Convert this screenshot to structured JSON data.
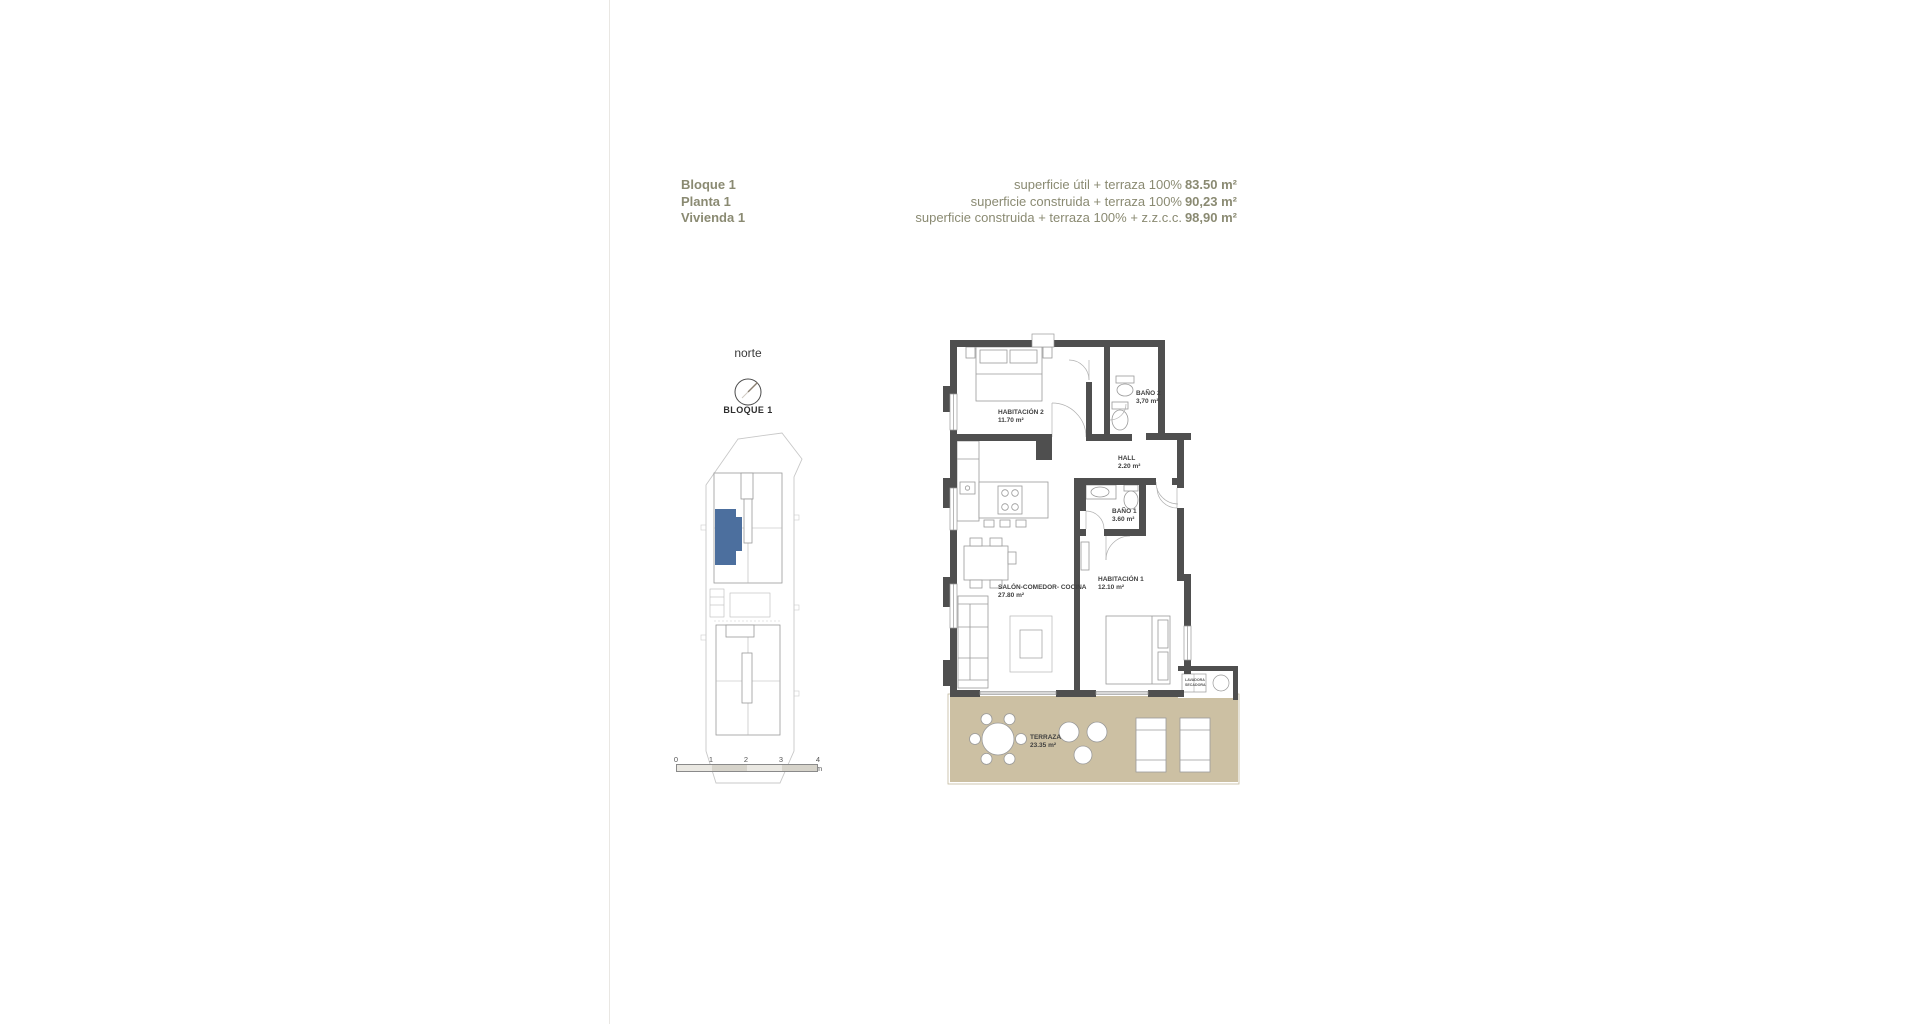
{
  "header": {
    "block": "Bloque 1",
    "floor": "Planta 1",
    "dwelling": "Vivienda 1",
    "accent_color": "#8a8a72",
    "areas": [
      {
        "label": "superficie útil + terraza 100%",
        "value": "83.50 m²"
      },
      {
        "label": "superficie construida + terraza 100%",
        "value": "90,23 m²"
      },
      {
        "label": "superficie construida + terraza 100% + z.z.c.c.",
        "value": "98,90 m²"
      }
    ]
  },
  "locator": {
    "north_label": "norte",
    "block_label": "BLOQUE 1",
    "highlight_color": "#4c6f9e",
    "scale_ticks": [
      "0",
      "1",
      "2",
      "3",
      "4 m"
    ]
  },
  "plan": {
    "wall_color": "#4f4f4f",
    "terrace_color": "#ccc0a3",
    "rooms": [
      {
        "name": "HABITACIÓN 2",
        "area": "11.70 m²"
      },
      {
        "name": "BAÑO 2",
        "area": "3,70 m²"
      },
      {
        "name": "HALL",
        "area": "2.20 m²"
      },
      {
        "name": "BAÑO 1",
        "area": "3.60 m²"
      },
      {
        "name": "HABITACIÓN 1",
        "area": "12.10 m²"
      },
      {
        "name": "SALÓN-COMEDOR- COCINA",
        "area": "27.80 m²"
      },
      {
        "name": "TERRAZA",
        "area": "23.35 m²"
      }
    ],
    "utility": {
      "line1": "LAVADORA",
      "line2": "SECADORA"
    }
  }
}
